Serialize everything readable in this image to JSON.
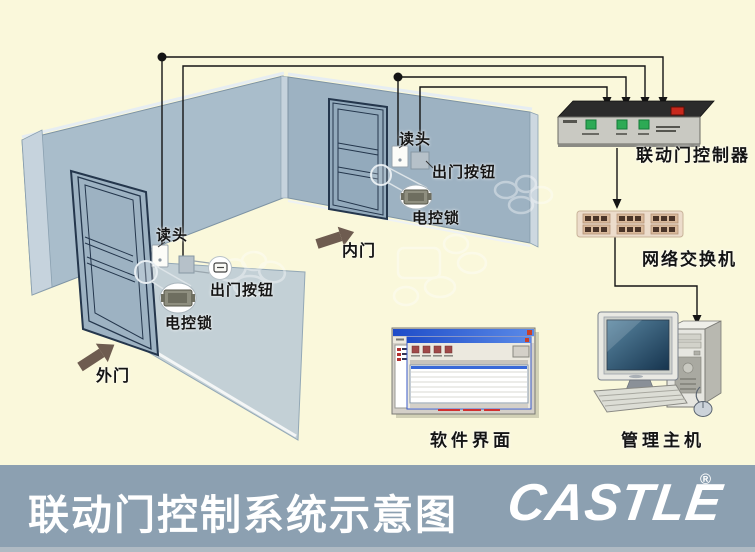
{
  "banner": {
    "title": "联动门控制系统示意图",
    "logo": "CASTLE",
    "registered": "®"
  },
  "labels": {
    "outer_reader": "读头",
    "outer_exit_button": "出门按钮",
    "outer_lock": "电控锁",
    "outer_door": "外门",
    "inner_reader": "读头",
    "inner_exit_button": "出门按钮",
    "inner_lock": "电控锁",
    "inner_door": "内门",
    "controller": "联动门控制器",
    "network_switch": "网络交换机",
    "software_ui": "软件界面",
    "management_host": "管理主机"
  },
  "colors": {
    "background": "#FAF8DB",
    "banner": "#8CA0B1",
    "wall_left": "#A9BDCB",
    "wall_right": "#9DB2C2",
    "controller_button_green": "#2DAA55",
    "controller_switch_red": "#C8281C",
    "switch_body_beige": "#ECDCCB",
    "arrow_brown": "#6E5C50"
  }
}
